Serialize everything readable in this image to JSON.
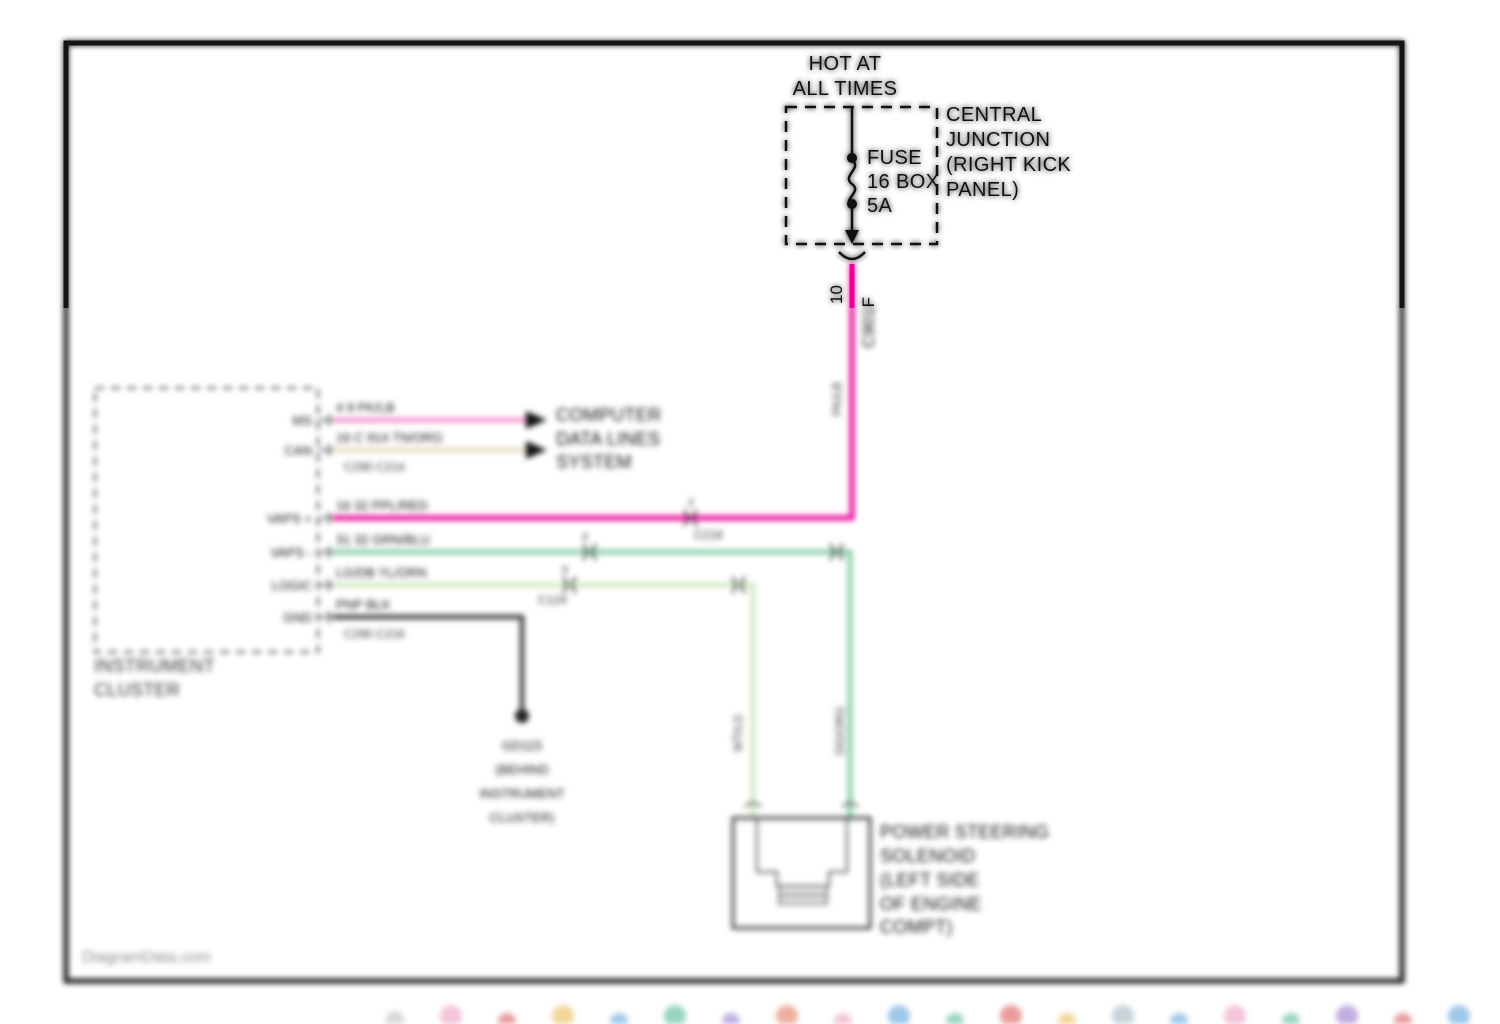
{
  "diagram": {
    "power_source": {
      "hot_lines": [
        "HOT AT",
        "ALL TIMES"
      ],
      "fuse_lines": [
        "FUSE",
        "16 BOX",
        "5A"
      ],
      "location_lines": [
        "CENTRAL",
        "JUNCTION",
        "(RIGHT KICK",
        "PANEL)"
      ],
      "feed_pin": "10",
      "feed_connector": "C901F",
      "feed_color_code": "PK/LB"
    },
    "instrument_cluster": {
      "name_lines": [
        "INSTRUMENT",
        "CLUSTER"
      ],
      "pins": [
        "MS",
        "CAN",
        "VAPS +",
        "VAPS -",
        "LOGIC",
        "GND"
      ]
    },
    "computer_data_lines": {
      "dest_lines": [
        "COMPUTER",
        "DATA LINES",
        "SYSTEM"
      ],
      "bus_plus_label": "4 9 PK/LB",
      "bus_minus_label": "16 C 914 TN/ORG",
      "connectors_label": "C290 C214"
    },
    "vaps_plus_wire": {
      "label": "16 32 PPL/RED",
      "inline_pin": "2",
      "inline_connector": "C218"
    },
    "vaps_minus_wire": {
      "label": "31 32 GRN/BLU",
      "inline_pin": "4",
      "drop_color_code": "DG/ORG"
    },
    "logic_wire": {
      "label": "LG/DB YL/ORN",
      "inline_pin": "5",
      "inline_connector": "C124",
      "drop_color_code": "WT/LG"
    },
    "ground_wire": {
      "label": "PNP BLK",
      "connectors_label": "C290 C216",
      "ground_lines": [
        "GD115",
        "(BEHIND",
        "INSTRUMENT",
        "CLUSTER)"
      ]
    },
    "solenoid": {
      "label_lines": [
        "POWER STEERING",
        "SOLENOID",
        "(LEFT SIDE",
        "OF ENGINE",
        "COMPT)"
      ]
    },
    "watermark": "DiagramData.com",
    "colors": {
      "feed_wire": "#EC0099",
      "bus_plus_wire": "#F27DC4",
      "bus_minus_wire": "#E7DCC1",
      "vaps_minus_wire": "#7CC9A0",
      "logic_wire": "#CDE8BB",
      "ground_wire": "#3A3A3A",
      "ink": "#111111"
    }
  }
}
